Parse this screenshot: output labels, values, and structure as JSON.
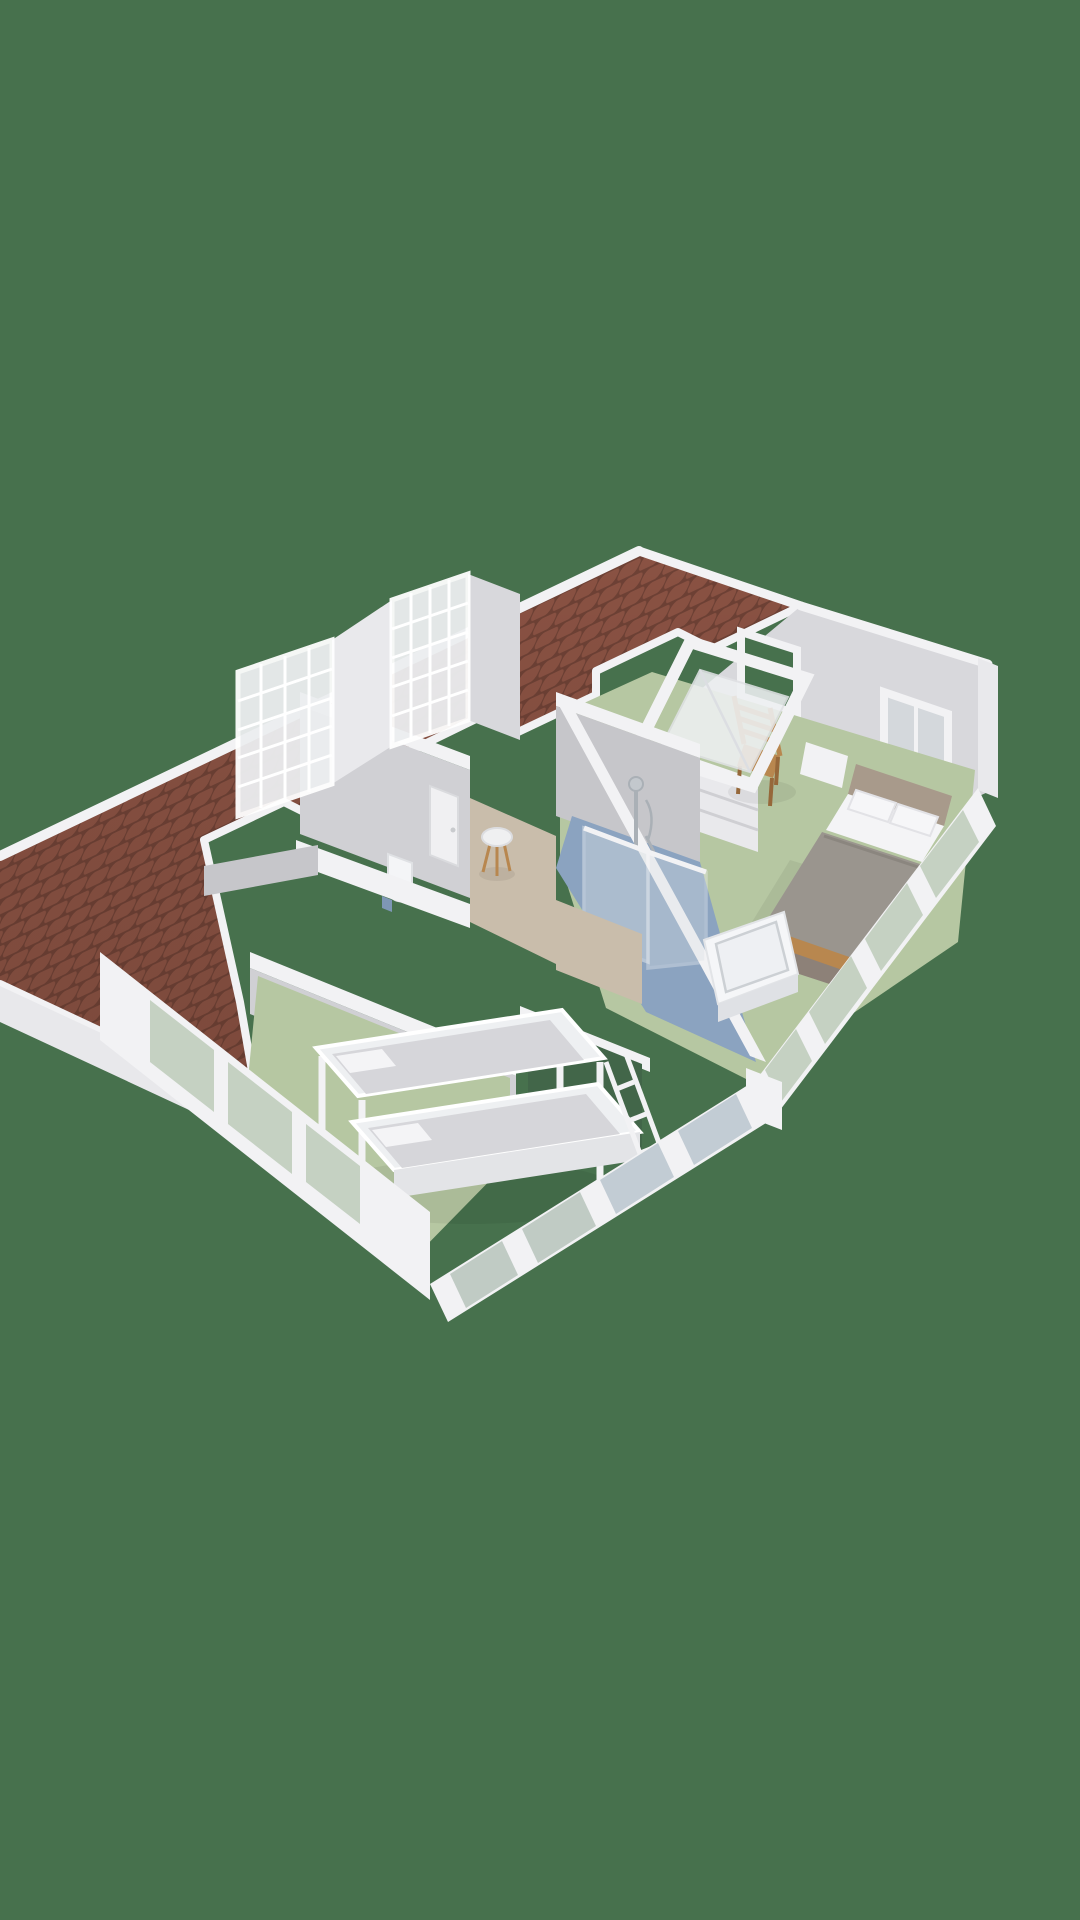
{
  "scene": {
    "kind": "3d-floorplan-render",
    "view": "isometric cutaway of attic storey",
    "background_color": "#47714d"
  },
  "palette": {
    "bg": "#47714d",
    "roof-tile": "#8a5243",
    "roof-tile-dark": "#6e4135",
    "fascia": "#f2f2f4",
    "wall-top": "#f2f2f4",
    "wall-light": "#e9e9ec",
    "wall-mid": "#d8d8dc",
    "wall-face": "#c6c6ca",
    "wall-shade": "#d0d0d4",
    "floor-green": "#b6c7a2",
    "floor-blue": "#8ba3c0",
    "floor-beige": "#c9bdab",
    "stair-void": "#426649",
    "glass": "#d9e0e3",
    "glass-tint-green": "#c5d1c2",
    "glass-tint-blue": "#c2ccd4",
    "linen": "#f4f4f6",
    "mattress": "#d6d6da",
    "duvet": "#9a958e",
    "headboard": "#a89a8b",
    "bed-base": "#8d8178",
    "wood": "#b8874f",
    "wood-dark": "#96683a",
    "chrome": "#aab0b6"
  },
  "roof": {
    "covering": "terracotta-tiles",
    "features": [
      "ridge",
      "eaves",
      "opened-skylight",
      "dormer-opening"
    ]
  },
  "rooms": [
    {
      "id": "master-bedroom",
      "floor_color": "#b6c7a2"
    },
    {
      "id": "second-bedroom",
      "floor_color": "#b6c7a2"
    },
    {
      "id": "bathroom",
      "floor_color": "#8ba3c0"
    },
    {
      "id": "landing",
      "floor_color": "#c9bdab"
    },
    {
      "id": "toilet-room",
      "floor_color": "#d0d0d4"
    }
  ],
  "furniture": [
    "double-bed",
    "nightstand",
    "wooden-chair",
    "low-bookshelf",
    "bunk-bed",
    "bunk-ladder",
    "round-stool",
    "toilet",
    "glass-shower",
    "shower-fixture",
    "washbasin",
    "skylight-window",
    "dormer-window",
    "glazed-partition",
    "stair-void"
  ]
}
